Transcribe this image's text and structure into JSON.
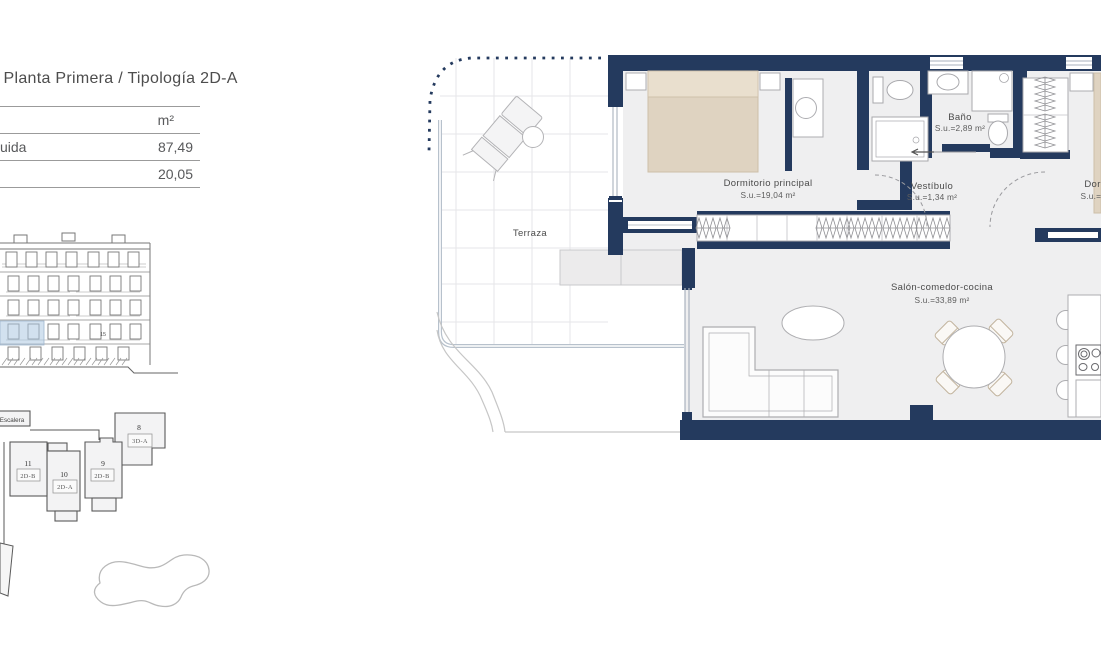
{
  "colors": {
    "wall": "#243A5E",
    "floor": "#EFEFF0",
    "bed": "#DFD3C1",
    "highlight": "#CADCEC",
    "glass": "#B7C1CC"
  },
  "header": {
    "title": "/ Planta Primera / Tipología 2D-A"
  },
  "area_table": {
    "unit_header": "m²",
    "rows": [
      {
        "label": "uida",
        "value": "87,49"
      },
      {
        "label": "",
        "value": "20,05"
      }
    ]
  },
  "elevation": {
    "unit_tag": "15"
  },
  "site_plan": {
    "stairs_label": "Escalera",
    "units": [
      {
        "number": "8",
        "type": "3D-A"
      },
      {
        "number": "9",
        "type": "2D-B"
      },
      {
        "number": "10",
        "type": "2D-A"
      },
      {
        "number": "11",
        "type": "2D-B"
      }
    ]
  },
  "floor_plan": {
    "rooms": [
      {
        "name": "Terraza",
        "area": ""
      },
      {
        "name": "Dormitorio principal",
        "area": "S.u.=19,04 m²"
      },
      {
        "name": "Baño",
        "area": "S.u.=2,89 m²"
      },
      {
        "name": "Vestíbulo",
        "area": "S.u.=1,34 m²"
      },
      {
        "name": "Dormitorio",
        "area": "S.u.=10,75 m²"
      },
      {
        "name": "Salón-comedor-cocina",
        "area": "S.u.=33,89 m²"
      }
    ]
  }
}
